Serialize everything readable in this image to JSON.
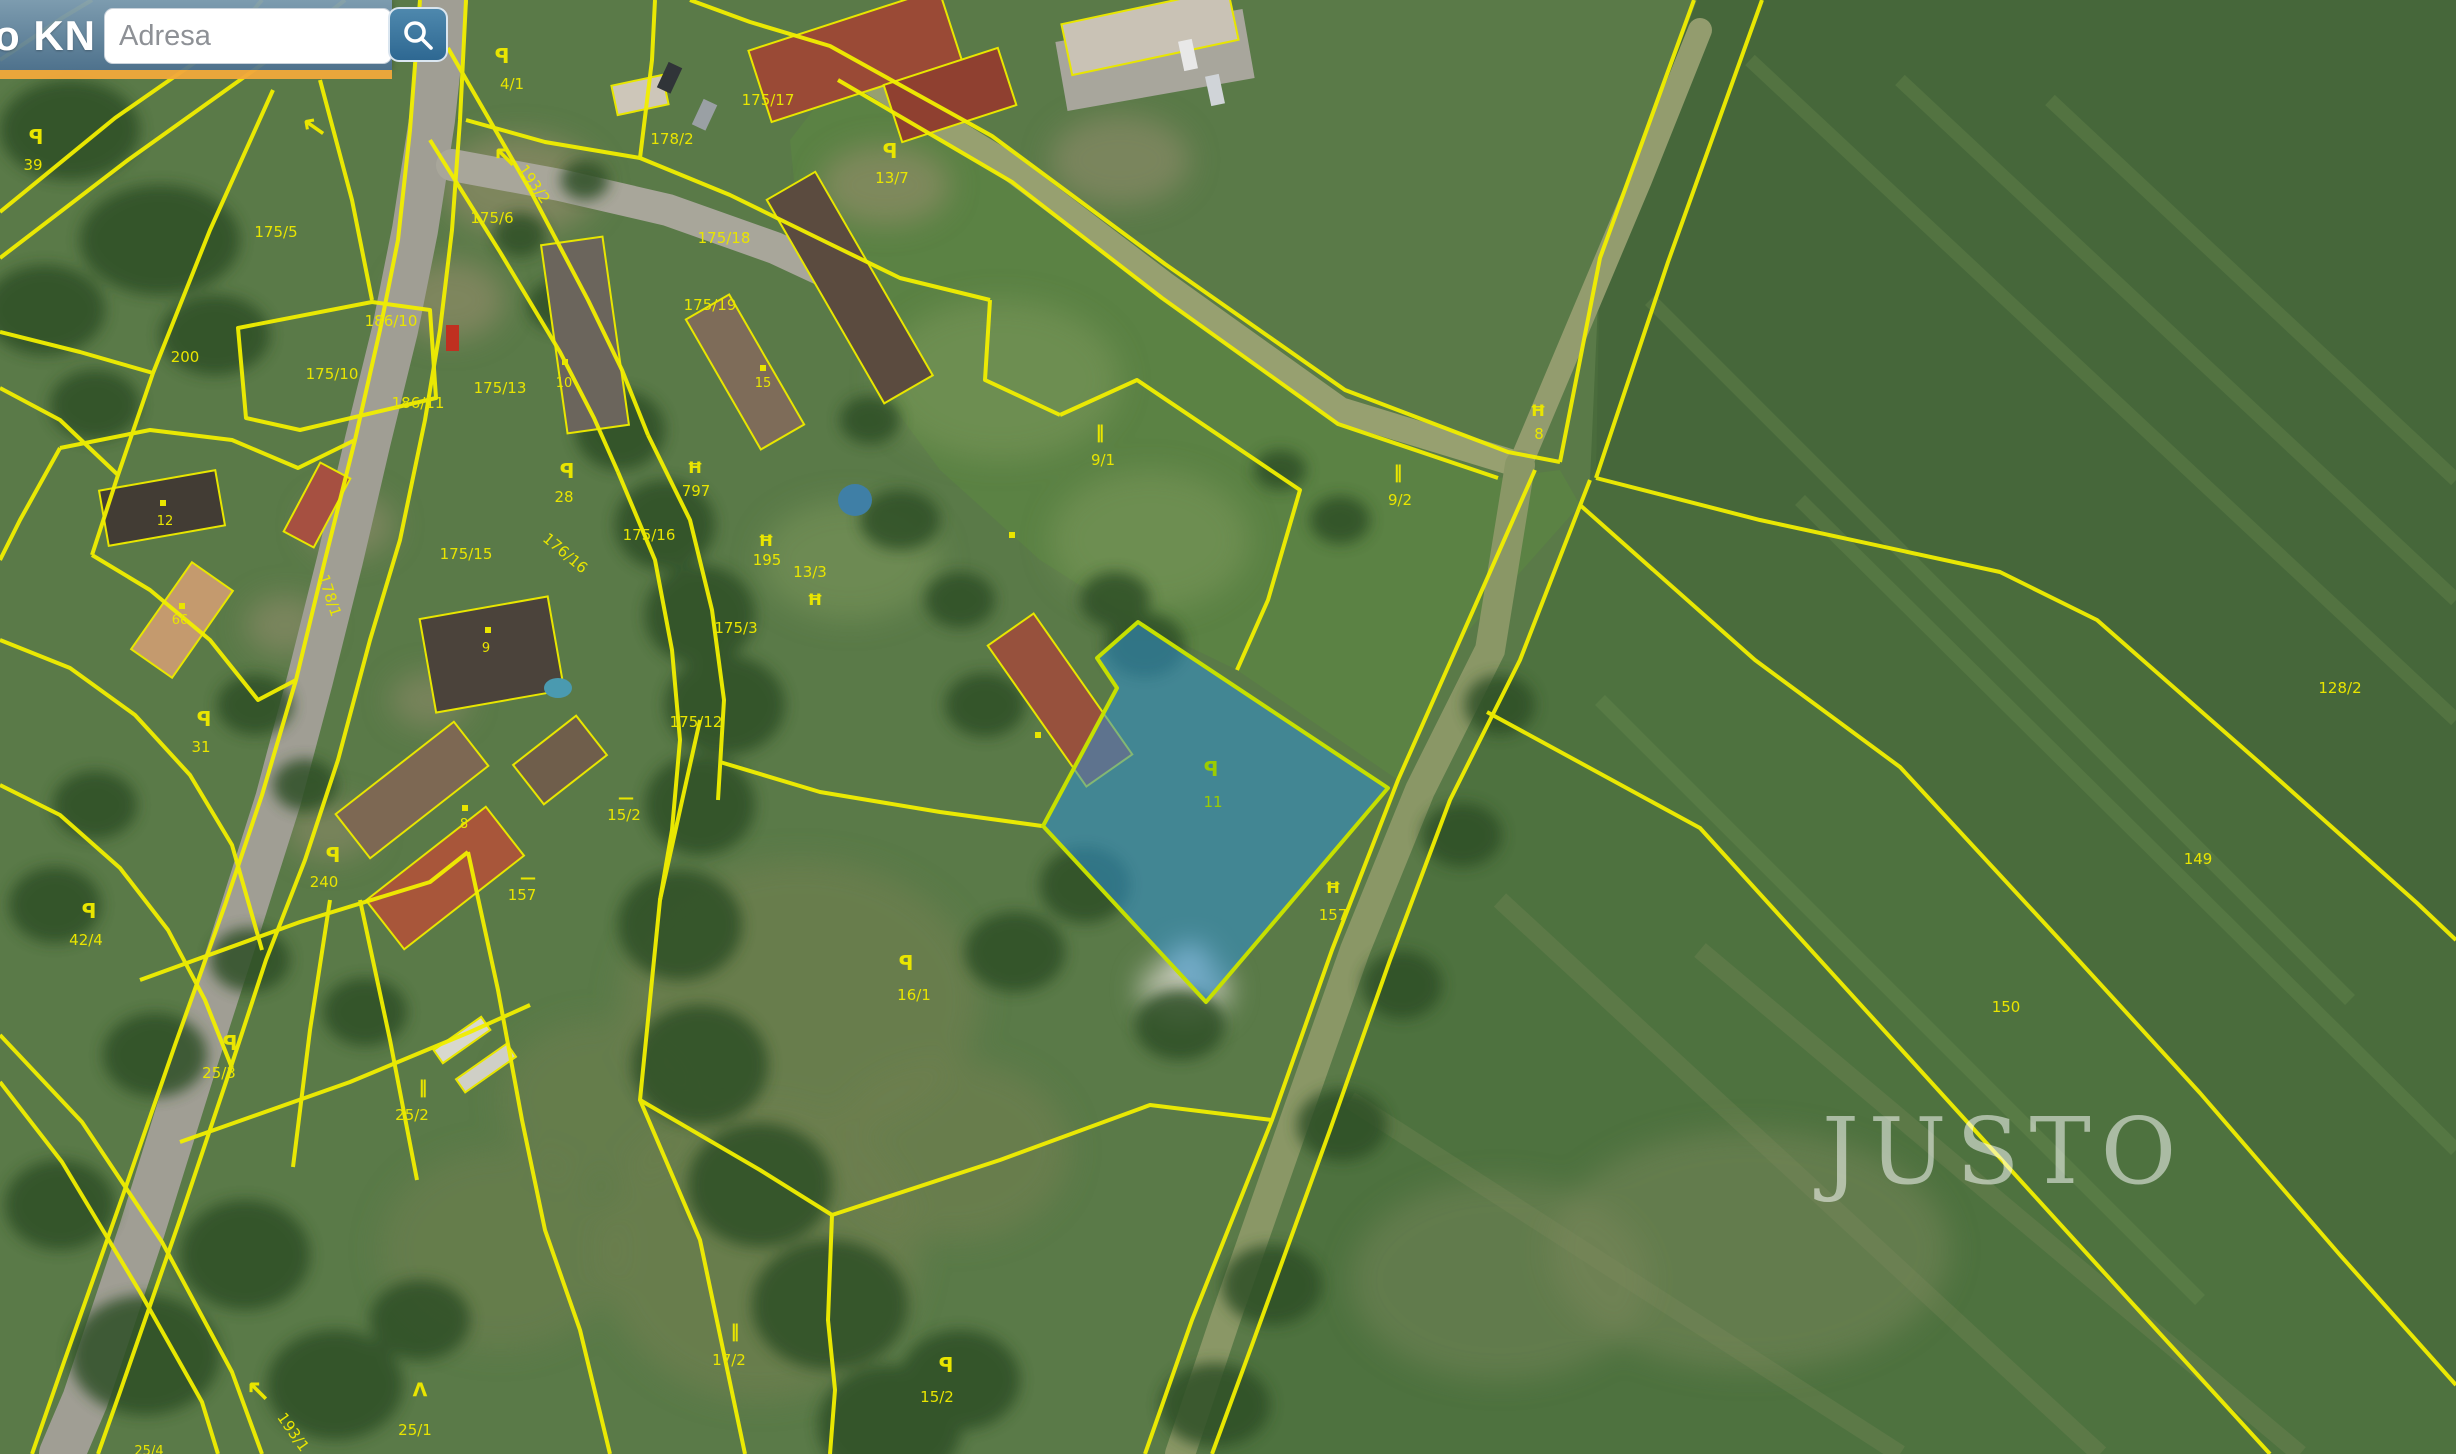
{
  "header": {
    "app_title": "o KN",
    "search": {
      "placeholder": "Adresa",
      "value": "",
      "button": "search"
    }
  },
  "watermark": {
    "text": "JUSTO"
  },
  "colors": {
    "parcel_line": "#f2ef00",
    "label": "#e9e500",
    "highlight_fill": "rgba(47,143,210,0.55)",
    "highlight_stroke": "#c6e000",
    "highlight_label": "#9ccc00",
    "header_accent": "#f2a93b"
  },
  "highlighted_parcel": {
    "id": "11"
  },
  "parcels": [
    {
      "id": "39",
      "x": 33,
      "y": 165,
      "sym": "p",
      "sx": 36,
      "sy": 138
    },
    {
      "id": "200",
      "x": 185,
      "y": 357
    },
    {
      "id": "175/5",
      "x": 276,
      "y": 232
    },
    {
      "id": "186/10",
      "x": 391,
      "y": 321
    },
    {
      "id": "175/10",
      "x": 332,
      "y": 374
    },
    {
      "id": "186/11",
      "x": 418,
      "y": 403
    },
    {
      "id": "175/13",
      "x": 500,
      "y": 388
    },
    {
      "id": "10",
      "x": 564,
      "y": 382,
      "small": true
    },
    {
      "id": "12",
      "x": 165,
      "y": 520,
      "small": true
    },
    {
      "id": "66",
      "x": 180,
      "y": 619,
      "small": true
    },
    {
      "id": "31",
      "x": 201,
      "y": 747,
      "sym": "p",
      "sx": 204,
      "sy": 720
    },
    {
      "id": "28",
      "x": 564,
      "y": 497,
      "sym": "p",
      "sx": 567,
      "sy": 472
    },
    {
      "id": "175/15",
      "x": 466,
      "y": 554
    },
    {
      "id": "9",
      "x": 486,
      "y": 647,
      "small": true
    },
    {
      "id": "8",
      "x": 464,
      "y": 823,
      "small": true
    },
    {
      "id": "15/2",
      "x": 624,
      "y": 815,
      "sym": "dash",
      "sx": 626,
      "sy": 797
    },
    {
      "id": "240",
      "x": 324,
      "y": 882,
      "sym": "p",
      "sx": 333,
      "sy": 856
    },
    {
      "id": "157",
      "x": 522,
      "y": 895,
      "sym": "dash",
      "sx": 528,
      "sy": 877
    },
    {
      "id": "42/4",
      "x": 86,
      "y": 940,
      "sym": "p",
      "sx": 89,
      "sy": 912
    },
    {
      "id": "25/3",
      "x": 219,
      "y": 1073,
      "sym": "p",
      "sx": 230,
      "sy": 1044
    },
    {
      "id": "25/2",
      "x": 412,
      "y": 1115,
      "sym": "dbar",
      "sx": 423,
      "sy": 1087
    },
    {
      "id": "25/1",
      "x": 415,
      "y": 1430,
      "sym": "lambda",
      "sx": 420,
      "sy": 1390
    },
    {
      "id": "25/4",
      "x": 149,
      "y": 1450,
      "small": true
    },
    {
      "id": "193/1",
      "x": 289,
      "y": 1430,
      "rot": 55
    },
    {
      "id": "4/1",
      "x": 512,
      "y": 84,
      "sym": "p",
      "sx": 502,
      "sy": 57
    },
    {
      "id": "193/2",
      "x": 530,
      "y": 182,
      "rot": 55
    },
    {
      "id": "178/2",
      "x": 672,
      "y": 139
    },
    {
      "id": "175/17",
      "x": 768,
      "y": 100
    },
    {
      "id": "13/7",
      "x": 892,
      "y": 178,
      "sym": "p",
      "sx": 890,
      "sy": 152
    },
    {
      "id": "175/18",
      "x": 724,
      "y": 238
    },
    {
      "id": "175/19",
      "x": 710,
      "y": 305
    },
    {
      "id": "15",
      "x": 763,
      "y": 382,
      "small": true
    },
    {
      "id": "175/6",
      "x": 492,
      "y": 218
    },
    {
      "id": "797",
      "x": 696,
      "y": 491,
      "sym": "gate",
      "sx": 695,
      "sy": 467
    },
    {
      "id": "195",
      "x": 767,
      "y": 560,
      "sym": "gate",
      "sx": 766,
      "sy": 540
    },
    {
      "id": "13/3",
      "x": 810,
      "y": 572,
      "sym": "gate",
      "sx": 815,
      "sy": 599
    },
    {
      "id": "175/3",
      "x": 736,
      "y": 628
    },
    {
      "id": "175/16",
      "x": 649,
      "y": 535
    },
    {
      "id": "175/12",
      "x": 696,
      "y": 722
    },
    {
      "id": "178/1",
      "x": 325,
      "y": 592,
      "rot": 72
    },
    {
      "id": "176/16",
      "x": 562,
      "y": 552,
      "rot": 40
    },
    {
      "id": "9/1",
      "x": 1103,
      "y": 460,
      "sym": "dbar",
      "sx": 1100,
      "sy": 432
    },
    {
      "id": "9/2",
      "x": 1400,
      "y": 500,
      "sym": "dbar",
      "sx": 1398,
      "sy": 472
    },
    {
      "id": "8",
      "x": 1539,
      "y": 434,
      "sym": "gate",
      "sx": 1538,
      "sy": 410
    },
    {
      "id": "157",
      "x": 1333,
      "y": 915,
      "sym": "gate",
      "sx": 1333,
      "sy": 887
    },
    {
      "id": "16/1",
      "x": 914,
      "y": 995,
      "sym": "p",
      "sx": 906,
      "sy": 964
    },
    {
      "id": "17/2",
      "x": 729,
      "y": 1360,
      "sym": "dbar",
      "sx": 735,
      "sy": 1331
    },
    {
      "id": "15/2",
      "x": 937,
      "y": 1397,
      "sym": "p",
      "sx": 946,
      "sy": 1366
    },
    {
      "id": "128/2",
      "x": 2340,
      "y": 688
    },
    {
      "id": "149",
      "x": 2198,
      "y": 859
    },
    {
      "id": "150",
      "x": 2006,
      "y": 1007
    },
    {
      "id": "11",
      "x": 1213,
      "y": 802,
      "sym": "p",
      "sx": 1211,
      "sy": 770,
      "color": "#9ccc00"
    }
  ],
  "arrows": [
    {
      "x": 316,
      "y": 128,
      "rot": -10
    },
    {
      "x": 505,
      "y": 158,
      "rot": 0
    },
    {
      "x": 258,
      "y": 1392,
      "rot": 0
    }
  ],
  "building_dots": [
    {
      "x": 565,
      "y": 362
    },
    {
      "x": 763,
      "y": 368
    },
    {
      "x": 163,
      "y": 503
    },
    {
      "x": 182,
      "y": 606
    },
    {
      "x": 488,
      "y": 630
    },
    {
      "x": 465,
      "y": 808
    },
    {
      "x": 1038,
      "y": 735
    },
    {
      "x": 1012,
      "y": 535
    }
  ]
}
